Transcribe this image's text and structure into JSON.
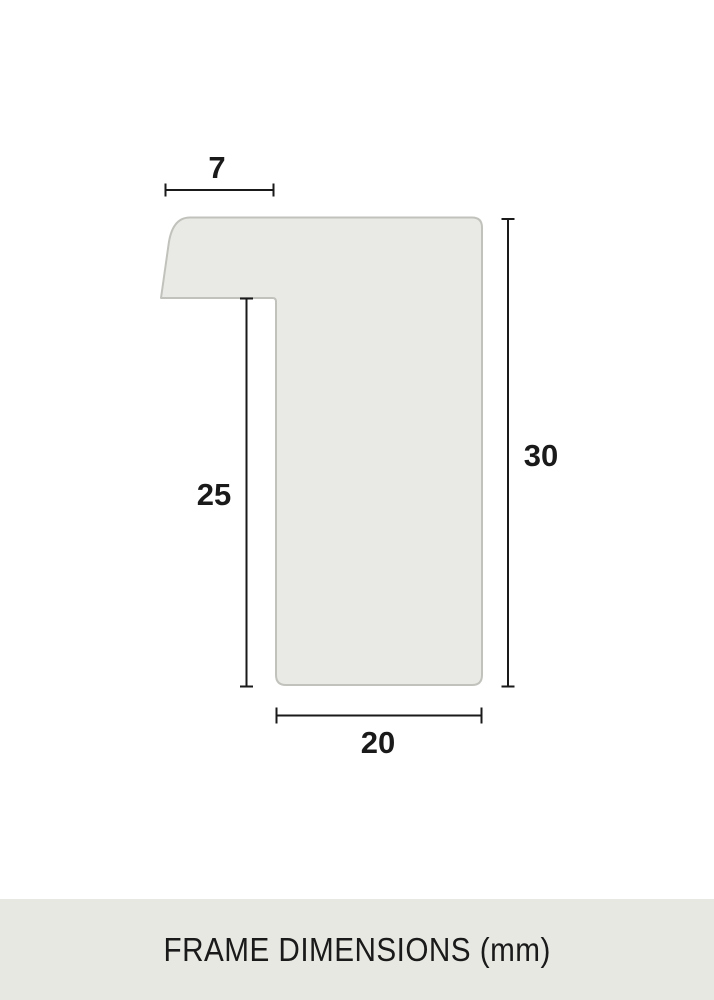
{
  "diagram": {
    "title": "Frame profile cross-section",
    "dimensions": {
      "top_width": {
        "value": "7"
      },
      "inner_height": {
        "value": "25"
      },
      "outer_height": {
        "value": "30"
      },
      "bottom_width": {
        "value": "20"
      }
    },
    "caption": "FRAME DIMENSIONS (mm)"
  },
  "colors": {
    "page_bg": "#ffffff",
    "shape_fill": "#e9e9e5",
    "shape_stroke": "#c2c2bd",
    "dimension_line": "#1a1a1a",
    "text": "#1a1a1a",
    "caption_bg": "#e8e8e3",
    "caption_text": "#1a1a1a"
  }
}
